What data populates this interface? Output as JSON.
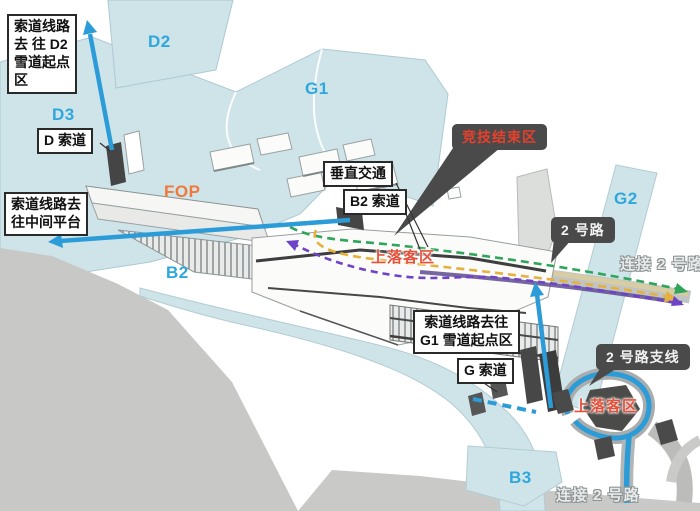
{
  "annotation_boxes": {
    "d2_route": {
      "lines": [
        "索道线路",
        "去 往 D2",
        "雪道起点",
        "区"
      ]
    },
    "d_cable": {
      "label": "D 索道"
    },
    "mid_platform": {
      "lines": [
        "索道线路去",
        "往中间平台"
      ]
    },
    "vertical_transport": {
      "label": "垂直交通"
    },
    "b2_cable": {
      "label": "B2 索道"
    },
    "g1_route": {
      "lines": [
        "索道线路去往",
        "G1 雪道起点区"
      ]
    },
    "g_cable": {
      "label": "G 索道"
    }
  },
  "dark_callouts": {
    "finish_zone": {
      "label": "竞技结束区"
    },
    "road_2": {
      "label": "2 号路"
    },
    "road_2_branch": {
      "label": "2 号路支线"
    }
  },
  "zone_labels": {
    "d2": "D2",
    "d3": "D3",
    "g1": "G1",
    "g2": "G2",
    "b2": "B2",
    "b3": "B3",
    "fop": "FOP"
  },
  "route_labels": {
    "pickup_dropoff_upper": "上落客区",
    "pickup_dropoff_lower": "上落客区",
    "connect_road_2_right": "连接 2 号路",
    "connect_road_2_bottom": "连接 2 号路"
  },
  "legend_colors": {
    "cable_route_blue": "#2b9cd8",
    "route_green": "#2fa55c",
    "route_yellow": "#e4b23c",
    "route_purple": "#6f42c8",
    "zone_fill": "#cfe4e9",
    "zone_label_blue": "#2ea7dd",
    "fop_orange": "#f0783a",
    "pickup_red": "#e4503a",
    "callout_dark": "#4a4a4a"
  }
}
